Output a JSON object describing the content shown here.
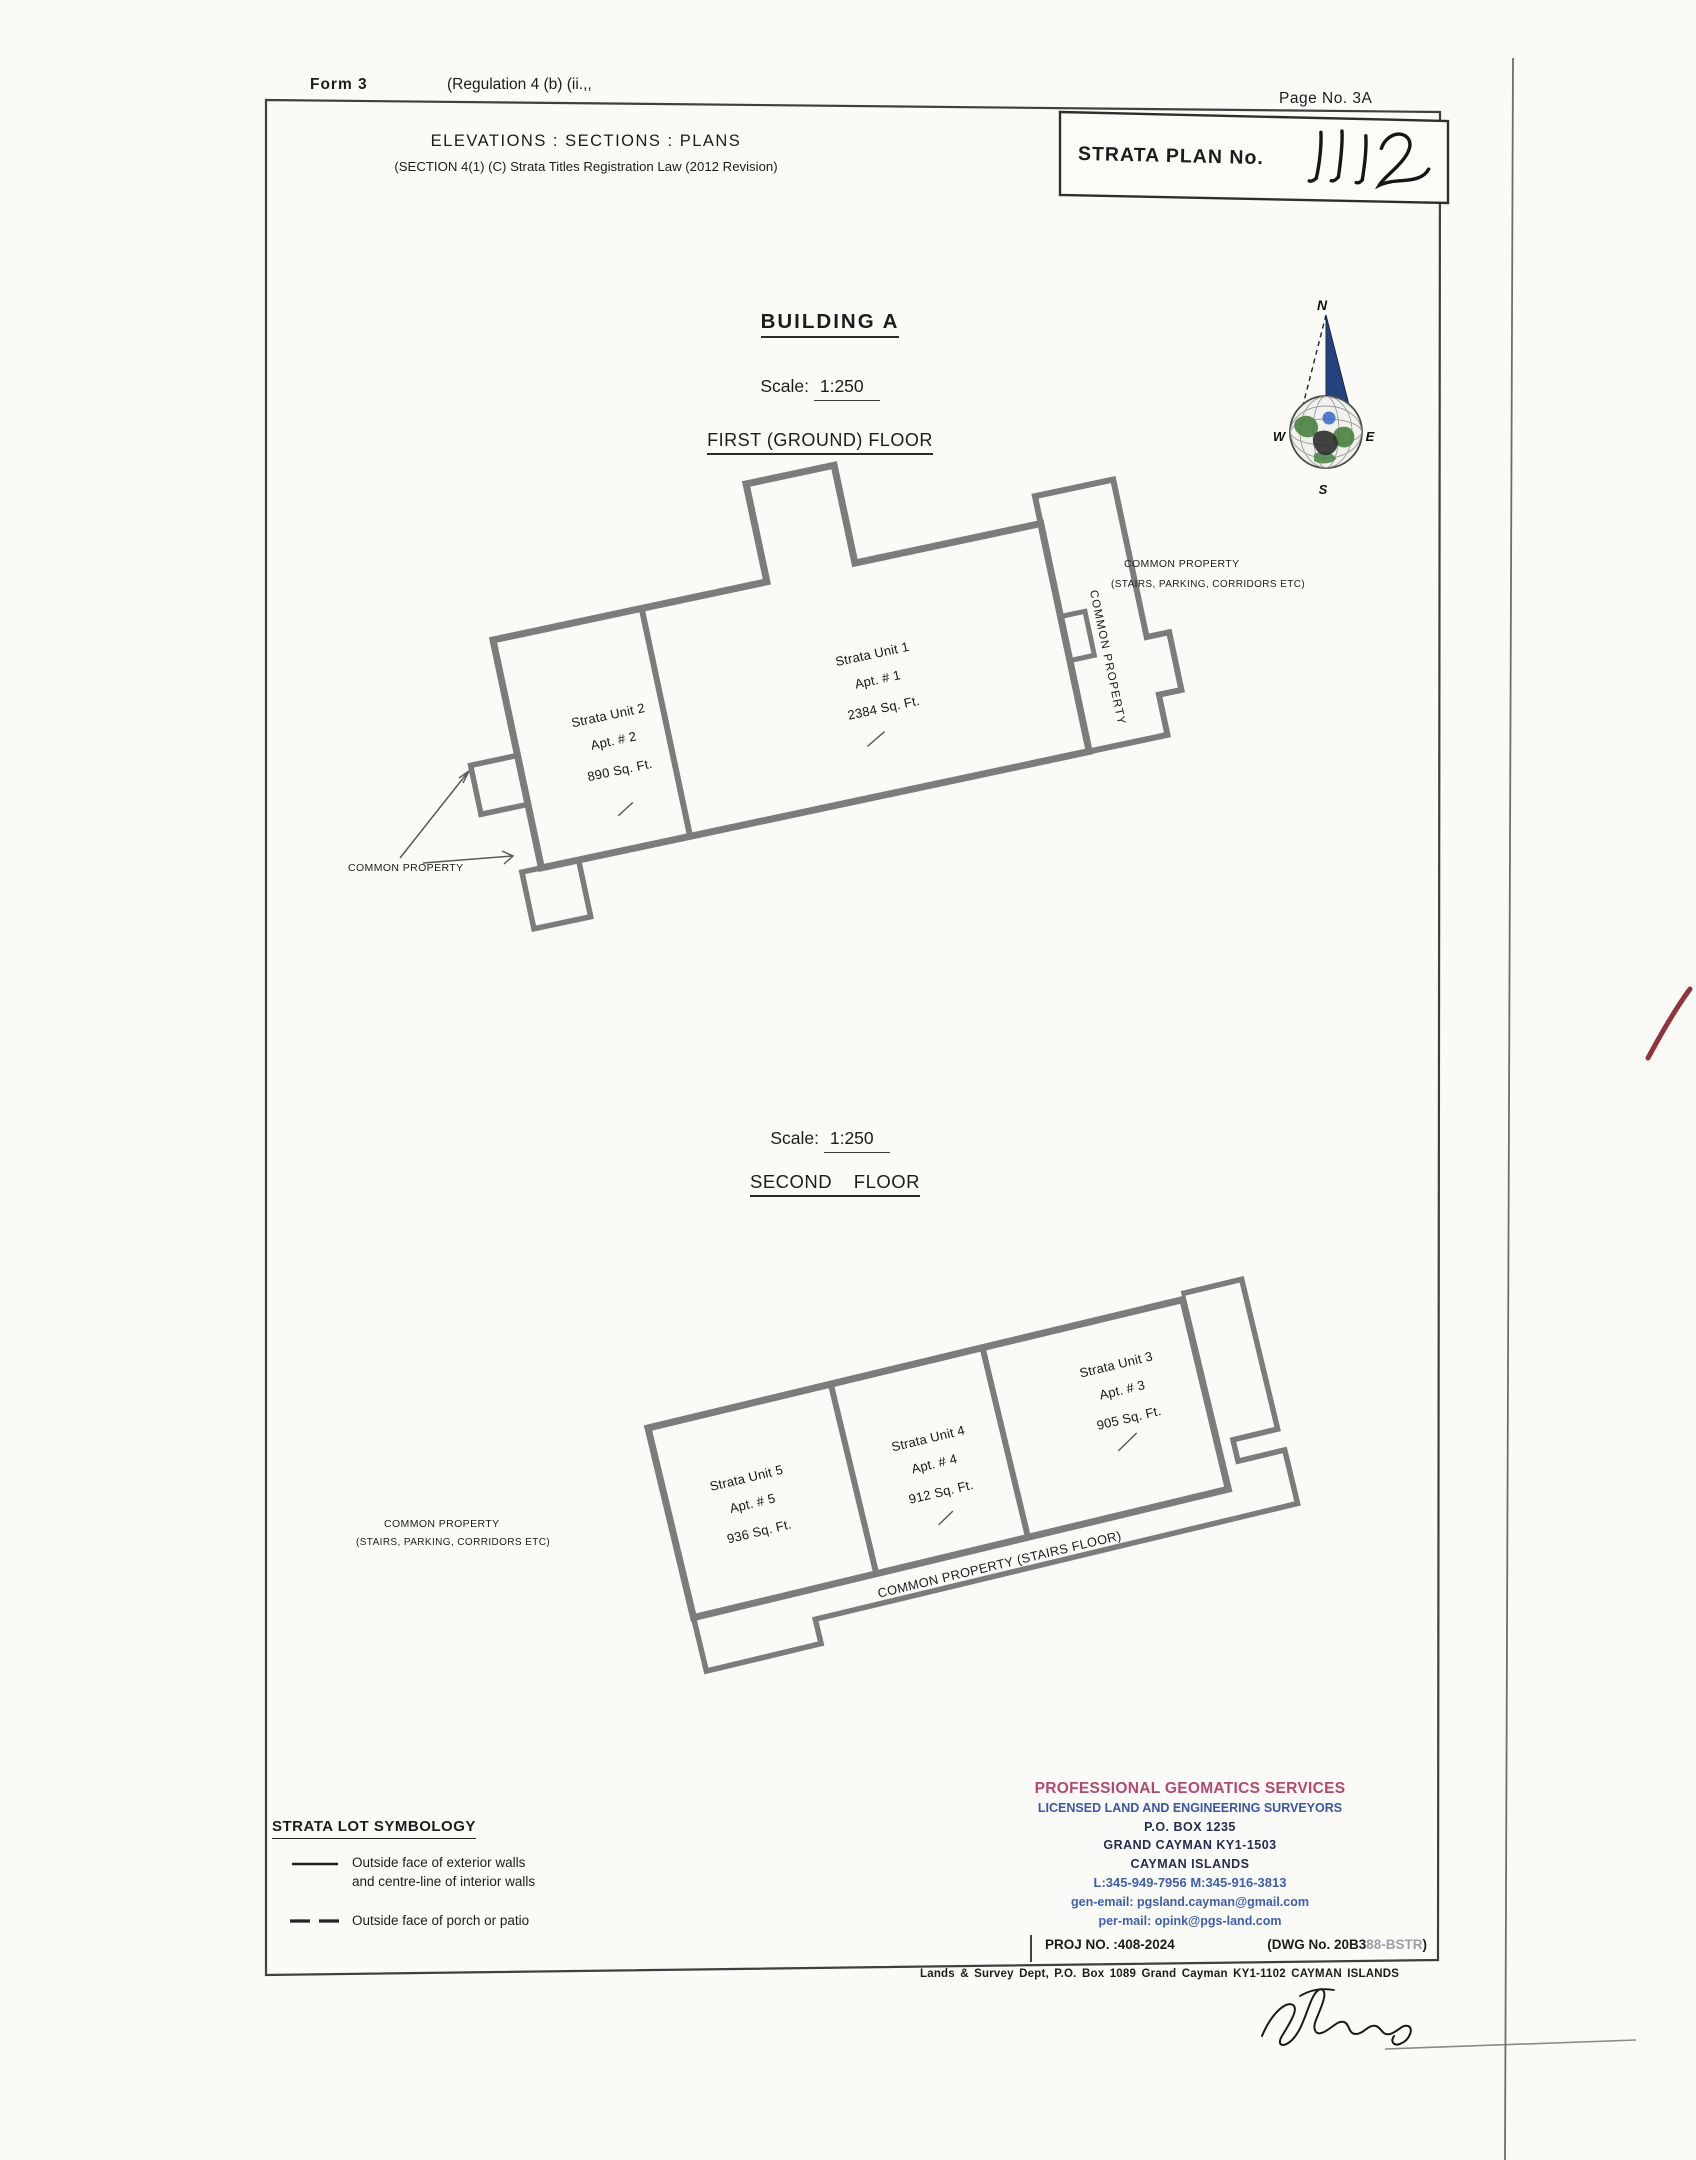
{
  "page": {
    "form_label": "Form 3",
    "regulation_label": "(Regulation 4 (b) (ii.,,",
    "page_no_label": "Page No. 3A",
    "strata_plan_label": "STRATA PLAN No.",
    "strata_plan_no_handwritten": "1112",
    "header_title": "ELEVATIONS : SECTIONS : PLANS",
    "header_subtitle": "(SECTION 4(1) (C) Strata Titles Registration Law (2012 Revision)"
  },
  "building": {
    "title": "BUILDING A"
  },
  "floor1": {
    "scale_label": "Scale:",
    "scale_value": "1:250",
    "floor_label": "FIRST (GROUND) FLOOR",
    "units": [
      {
        "name": "Strata Unit 1",
        "apt": "Apt. # 1",
        "area": "2384 Sq. Ft."
      },
      {
        "name": "Strata Unit 2",
        "apt": "Apt. # 2",
        "area": "890 Sq. Ft."
      }
    ],
    "corridor_label": "COMMON PROPERTY",
    "right_note_line1": "COMMON PROPERTY",
    "right_note_line2": "(STAIRS, PARKING, CORRIDORS ETC)",
    "porch_note": "COMMON PROPERTY"
  },
  "floor2": {
    "scale_label": "Scale:",
    "scale_value": "1:250",
    "floor_label": "SECOND FLOOR",
    "units": [
      {
        "name": "Strata Unit 3",
        "apt": "Apt. # 3",
        "area": "905 Sq. Ft."
      },
      {
        "name": "Strata Unit 4",
        "apt": "Apt. # 4",
        "area": "912 Sq. Ft."
      },
      {
        "name": "Strata Unit 5",
        "apt": "Apt. # 5",
        "area": "936 Sq. Ft."
      }
    ],
    "corridor_label": "COMMON PROPERTY (STAIRS FLOOR)",
    "left_note_line1": "COMMON PROPERTY",
    "left_note_line2": "(STAIRS, PARKING, CORRIDORS ETC)"
  },
  "compass": {
    "n": "N",
    "e": "E",
    "s": "S",
    "w": "W"
  },
  "legend": {
    "title": "STRATA LOT SYMBOLOGY",
    "items": [
      {
        "line1": "Outside face of exterior walls",
        "line2": "and centre-line of interior walls"
      },
      {
        "line1": "Outside face of porch or patio"
      }
    ]
  },
  "surveyor": {
    "name": "PROFESSIONAL GEOMATICS SERVICES",
    "tagline": "LICENSED LAND AND ENGINEERING SURVEYORS",
    "po_box": "P.O. BOX 1235",
    "city": "GRAND CAYMAN KY1-1503",
    "country": "CAYMAN ISLANDS",
    "phones": "L:345-949-7956   M:345-916-3813",
    "gen_email": "gen-email:  pgsland.cayman@gmail.com",
    "per_email": "per-mail:  opink@pgs-land.com",
    "proj_no": "PROJ NO. :408-2024",
    "dwg_prefix": "(DWG No. 20B3",
    "dwg_faded": "88-BSTR",
    "dwg_suffix": ")"
  },
  "footer": {
    "lands_dept": "Lands & Survey Dept, P.O. Box 1089 Grand Cayman   KY1-1102   CAYMAN ISLANDS"
  },
  "colors": {
    "wall_gray": "#7c7c7c",
    "accent_pink": "#b5486e",
    "accent_blue": "#3a56a8",
    "dark_navy": "#232c52",
    "red_tick": "#93333f"
  }
}
